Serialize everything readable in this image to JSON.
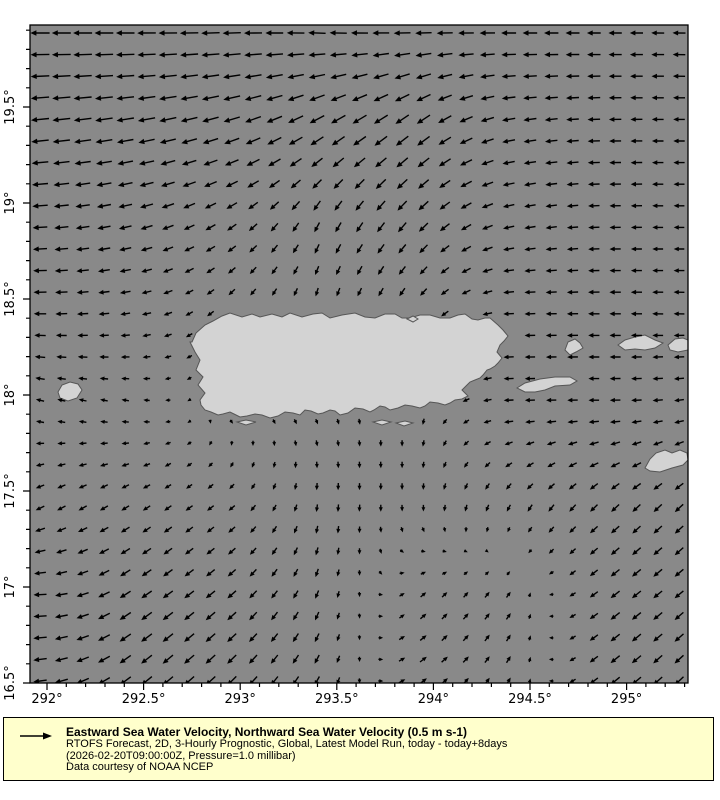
{
  "legend": {
    "bg_color": "#ffffcc",
    "arrow_color": "#000000",
    "title": "Eastward Sea Water Velocity, Northward Sea Water Velocity (0.5 m s-1)",
    "line2": "RTOFS Forecast, 2D, 3-Hourly Prognostic, Global, Latest Model Run, today - today+8days",
    "line3": "(2026-02-20T09:00:00Z, Pressure=1.0 millibar)",
    "line4": "Data courtesy of NOAA NCEP"
  },
  "figure": {
    "plot": {
      "left": 30,
      "top": 25,
      "width": 658,
      "height": 658,
      "sea_color": "#898989",
      "land_color": "#d3d3d3",
      "land_outline": "#565656",
      "border_color": "#000000",
      "arrow_color": "#000000"
    },
    "x_axis": {
      "origin_lon": 292,
      "origin_px": 17,
      "px_per_deg": 193.2,
      "range": [
        291.915,
        295.315
      ],
      "major": [
        {
          "lon": 292.0,
          "label": "292°"
        },
        {
          "lon": 292.5,
          "label": "292.5°"
        },
        {
          "lon": 293.0,
          "label": "293°"
        },
        {
          "lon": 293.5,
          "label": "293.5°"
        },
        {
          "lon": 294.0,
          "label": "294°"
        },
        {
          "lon": 294.5,
          "label": "294.5°"
        },
        {
          "lon": 295.0,
          "label": "295°"
        }
      ],
      "minor_step": 0.1
    },
    "y_axis": {
      "origin_lat": 16.5,
      "origin_px": 658,
      "px_per_deg": 192,
      "range": [
        16.5,
        19.925
      ],
      "major": [
        {
          "lat": 16.5,
          "label": "16.5°"
        },
        {
          "lat": 17.0,
          "label": "17°"
        },
        {
          "lat": 17.5,
          "label": "17.5°"
        },
        {
          "lat": 18.0,
          "label": "18°"
        },
        {
          "lat": 18.5,
          "label": "18.5°"
        },
        {
          "lat": 19.0,
          "label": "19°"
        },
        {
          "lat": 19.5,
          "label": "19.5°"
        }
      ],
      "minor_step": 0.1
    }
  },
  "chart_data": {
    "type": "quiver",
    "title": "Eastward Sea Water Velocity, Northward Sea Water Velocity (0.5 m s-1)",
    "variable": "sea water velocity",
    "reference_arrow": {
      "label": "0.5 m s-1",
      "speed_m_s": 0.5
    },
    "geo_extent": {
      "lon_min": 291.92,
      "lon_max": 295.32,
      "lat_min": 16.5,
      "lat_max": 19.93
    },
    "grid": {
      "x0": 10,
      "y0": 8,
      "dx": 21.3,
      "dy": 21.6,
      "cols": 31,
      "rows": 31
    },
    "arrow_style": {
      "min_len": 3,
      "len_scale": 17,
      "stroke_width": 1.4
    },
    "control_field": {
      "angle_convention": "degrees clockwise from east, screen coords (+y down); speed 0..1",
      "xs": [
        10,
        100,
        195,
        290,
        385,
        480,
        575,
        655
      ],
      "ys": [
        10,
        100,
        195,
        290,
        385,
        480,
        575,
        650
      ],
      "vectors": [
        [
          [
            180,
            0.95
          ],
          [
            180,
            0.92
          ],
          [
            178,
            0.9
          ],
          [
            182,
            0.85
          ],
          [
            178,
            0.8
          ],
          [
            180,
            0.7
          ],
          [
            180,
            0.62
          ],
          [
            181,
            0.58
          ]
        ],
        [
          [
            174,
            0.88
          ],
          [
            170,
            0.85
          ],
          [
            163,
            0.82
          ],
          [
            150,
            0.8
          ],
          [
            143,
            0.78
          ],
          [
            170,
            0.6
          ],
          [
            179,
            0.55
          ],
          [
            180,
            0.5
          ]
        ],
        [
          [
            176,
            0.7
          ],
          [
            166,
            0.6
          ],
          [
            148,
            0.5
          ],
          [
            118,
            0.5
          ],
          [
            133,
            0.6
          ],
          [
            168,
            0.5
          ],
          [
            179,
            0.48
          ],
          [
            180,
            0.45
          ]
        ],
        [
          [
            180,
            0.55
          ],
          [
            172,
            0.4
          ],
          [
            135,
            0.3
          ],
          [
            100,
            0.3
          ],
          [
            125,
            0.35
          ],
          [
            178,
            0.45
          ],
          [
            180,
            0.5
          ],
          [
            181,
            0.45
          ]
        ],
        [
          [
            196,
            0.3
          ],
          [
            192,
            0.25
          ],
          [
            30,
            0.12
          ],
          [
            60,
            0.15
          ],
          [
            95,
            0.2
          ],
          [
            178,
            0.4
          ],
          [
            180,
            0.45
          ],
          [
            172,
            0.4
          ]
        ],
        [
          [
            152,
            0.38
          ],
          [
            148,
            0.35
          ],
          [
            142,
            0.3
          ],
          [
            95,
            0.28
          ],
          [
            88,
            0.22
          ],
          [
            118,
            0.3
          ],
          [
            137,
            0.45
          ],
          [
            137,
            0.5
          ]
        ],
        [
          [
            178,
            0.6
          ],
          [
            146,
            0.6
          ],
          [
            140,
            0.52
          ],
          [
            112,
            0.35
          ],
          [
            318,
            0.28
          ],
          [
            305,
            0.28
          ],
          [
            143,
            0.5
          ],
          [
            140,
            0.5
          ]
        ],
        [
          [
            172,
            0.62
          ],
          [
            142,
            0.65
          ],
          [
            136,
            0.6
          ],
          [
            118,
            0.42
          ],
          [
            325,
            0.35
          ],
          [
            300,
            0.3
          ],
          [
            141,
            0.52
          ],
          [
            137,
            0.55
          ]
        ]
      ]
    },
    "landmasses": [
      {
        "name": "puerto-rico",
        "points": [
          [
            162,
            317
          ],
          [
            166,
            308
          ],
          [
            175,
            300
          ],
          [
            183,
            296
          ],
          [
            192,
            291
          ],
          [
            200,
            288
          ],
          [
            212,
            292
          ],
          [
            222,
            289
          ],
          [
            230,
            292
          ],
          [
            242,
            289
          ],
          [
            252,
            292
          ],
          [
            260,
            288
          ],
          [
            272,
            292
          ],
          [
            283,
            289
          ],
          [
            292,
            288
          ],
          [
            300,
            293
          ],
          [
            312,
            290
          ],
          [
            325,
            288
          ],
          [
            335,
            292
          ],
          [
            345,
            293
          ],
          [
            355,
            289
          ],
          [
            365,
            289
          ],
          [
            372,
            293
          ],
          [
            380,
            293
          ],
          [
            390,
            290
          ],
          [
            400,
            290
          ],
          [
            410,
            293
          ],
          [
            420,
            293
          ],
          [
            428,
            290
          ],
          [
            435,
            289
          ],
          [
            442,
            294
          ],
          [
            448,
            295
          ],
          [
            455,
            293
          ],
          [
            460,
            293
          ],
          [
            468,
            300
          ],
          [
            473,
            305
          ],
          [
            478,
            311
          ],
          [
            474,
            316
          ],
          [
            470,
            320
          ],
          [
            467,
            327
          ],
          [
            472,
            333
          ],
          [
            468,
            338
          ],
          [
            465,
            341
          ],
          [
            460,
            344
          ],
          [
            457,
            345
          ],
          [
            453,
            350
          ],
          [
            450,
            353
          ],
          [
            445,
            355
          ],
          [
            440,
            357
          ],
          [
            436,
            361
          ],
          [
            432,
            365
          ],
          [
            438,
            371
          ],
          [
            432,
            374
          ],
          [
            425,
            375
          ],
          [
            420,
            378
          ],
          [
            415,
            380
          ],
          [
            408,
            378
          ],
          [
            400,
            377
          ],
          [
            395,
            381
          ],
          [
            390,
            383
          ],
          [
            382,
            381
          ],
          [
            375,
            380
          ],
          [
            368,
            383
          ],
          [
            360,
            385
          ],
          [
            355,
            382
          ],
          [
            350,
            381
          ],
          [
            344,
            385
          ],
          [
            340,
            387
          ],
          [
            333,
            384
          ],
          [
            325,
            383
          ],
          [
            318,
            388
          ],
          [
            310,
            390
          ],
          [
            305,
            386
          ],
          [
            300,
            385
          ],
          [
            293,
            388
          ],
          [
            288,
            389
          ],
          [
            281,
            386
          ],
          [
            275,
            385
          ],
          [
            270,
            390
          ],
          [
            263,
            388
          ],
          [
            255,
            387
          ],
          [
            248,
            391
          ],
          [
            240,
            393
          ],
          [
            232,
            390
          ],
          [
            225,
            389
          ],
          [
            217,
            391
          ],
          [
            210,
            392
          ],
          [
            204,
            389
          ],
          [
            200,
            387
          ],
          [
            193,
            389
          ],
          [
            188,
            390
          ],
          [
            181,
            387
          ],
          [
            175,
            385
          ],
          [
            171,
            380
          ],
          [
            170,
            375
          ],
          [
            175,
            368
          ],
          [
            168,
            360
          ],
          [
            173,
            352
          ],
          [
            166,
            345
          ],
          [
            170,
            335
          ],
          [
            165,
            327
          ],
          [
            160,
            317
          ]
        ]
      },
      {
        "name": "vieques",
        "points": [
          [
            487,
            363
          ],
          [
            495,
            358
          ],
          [
            510,
            354
          ],
          [
            525,
            352
          ],
          [
            540,
            352
          ],
          [
            547,
            356
          ],
          [
            540,
            360
          ],
          [
            525,
            361
          ],
          [
            515,
            365
          ],
          [
            505,
            367
          ],
          [
            495,
            367
          ]
        ]
      },
      {
        "name": "culebra",
        "points": [
          [
            535,
            325
          ],
          [
            538,
            317
          ],
          [
            545,
            314
          ],
          [
            550,
            318
          ],
          [
            553,
            323
          ],
          [
            546,
            327
          ],
          [
            540,
            330
          ]
        ]
      },
      {
        "name": "st-thomas",
        "points": [
          [
            588,
            320
          ],
          [
            595,
            315
          ],
          [
            605,
            312
          ],
          [
            615,
            310
          ],
          [
            625,
            315
          ],
          [
            633,
            318
          ],
          [
            625,
            323
          ],
          [
            615,
            325
          ],
          [
            605,
            324
          ],
          [
            595,
            325
          ]
        ]
      },
      {
        "name": "virgin-islands-east",
        "points": [
          [
            638,
            320
          ],
          [
            645,
            314
          ],
          [
            653,
            313
          ],
          [
            658,
            315
          ],
          [
            658,
            325
          ],
          [
            648,
            327
          ],
          [
            640,
            325
          ]
        ]
      },
      {
        "name": "st-croix",
        "points": [
          [
            615,
            443
          ],
          [
            620,
            434
          ],
          [
            626,
            428
          ],
          [
            635,
            425
          ],
          [
            642,
            428
          ],
          [
            650,
            425
          ],
          [
            657,
            428
          ],
          [
            658,
            435
          ],
          [
            653,
            440
          ],
          [
            642,
            443
          ],
          [
            630,
            447
          ],
          [
            620,
            446
          ]
        ]
      },
      {
        "name": "mona",
        "points": [
          [
            28,
            367
          ],
          [
            32,
            360
          ],
          [
            40,
            357
          ],
          [
            48,
            359
          ],
          [
            52,
            365
          ],
          [
            47,
            373
          ],
          [
            38,
            376
          ],
          [
            30,
            373
          ]
        ]
      },
      {
        "name": "ne-cay",
        "points": [
          [
            377,
            294
          ],
          [
            383,
            291
          ],
          [
            388,
            294
          ],
          [
            383,
            297
          ]
        ]
      },
      {
        "name": "south-cay-1",
        "points": [
          [
            207,
            397
          ],
          [
            216,
            395
          ],
          [
            226,
            397
          ],
          [
            216,
            400
          ]
        ]
      },
      {
        "name": "south-cay-2",
        "points": [
          [
            343,
            397
          ],
          [
            352,
            395
          ],
          [
            361,
            397
          ],
          [
            352,
            400
          ]
        ]
      },
      {
        "name": "south-cay-3",
        "points": [
          [
            366,
            398
          ],
          [
            375,
            396
          ],
          [
            383,
            398
          ],
          [
            374,
            401
          ]
        ]
      }
    ]
  }
}
